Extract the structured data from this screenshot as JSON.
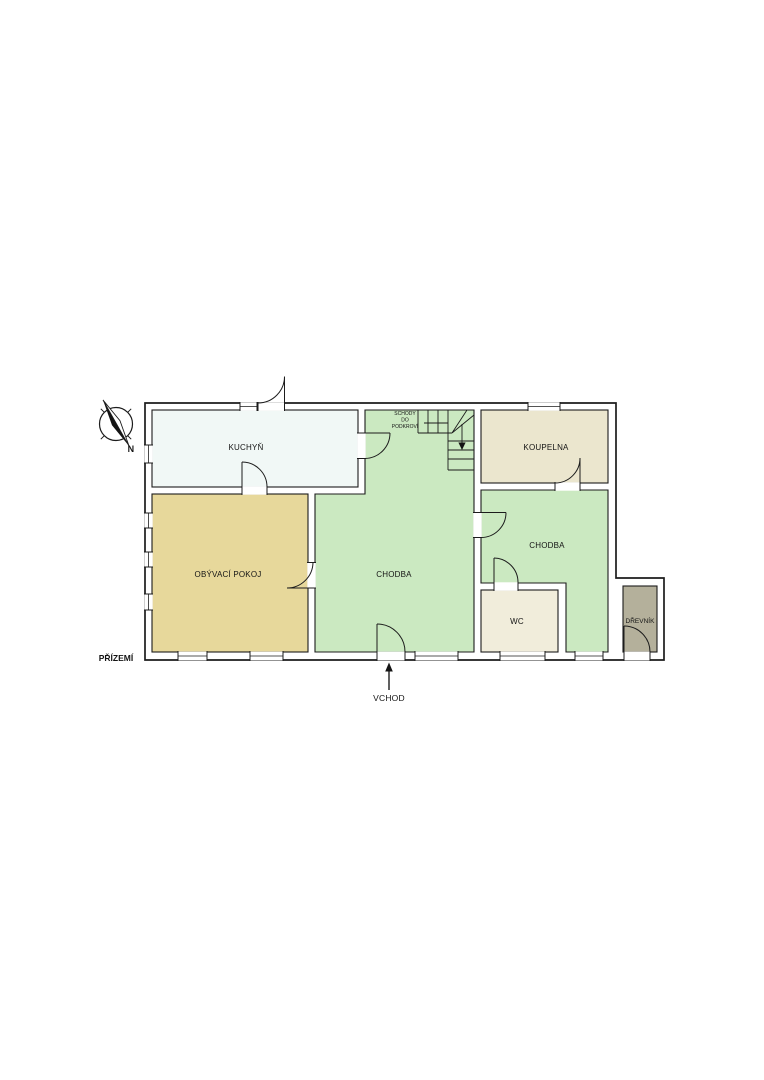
{
  "plan": {
    "floor_label": "PŘÍZEMÍ",
    "entrance": {
      "label": "VCHOD"
    },
    "stairs": {
      "line1": "SCHODY",
      "line2": "DO",
      "line3": "PODKROVÍ"
    },
    "compass": {
      "north_label": "N"
    },
    "rooms": {
      "kuchyn": {
        "label": "KUCHYŇ",
        "color": "#f1f8f6"
      },
      "obyvaci_pokoj": {
        "label": "OBÝVACÍ POKOJ",
        "color": "#e7d89b"
      },
      "chodba_main": {
        "label": "CHODBA",
        "color": "#cbe9c1"
      },
      "koupelna": {
        "label": "KOUPELNA",
        "color": "#ebe6ce"
      },
      "chodba_2": {
        "label": "CHODBA",
        "color": "#cbe9c1"
      },
      "wc": {
        "label": "WC",
        "color": "#f1eddb"
      },
      "drevnik": {
        "label": "DŘEVNÍK",
        "color": "#b4b09b"
      }
    },
    "colors": {
      "wall_fill": "#ffffff",
      "line": "#1c1c1c",
      "background": "#ffffff"
    }
  }
}
